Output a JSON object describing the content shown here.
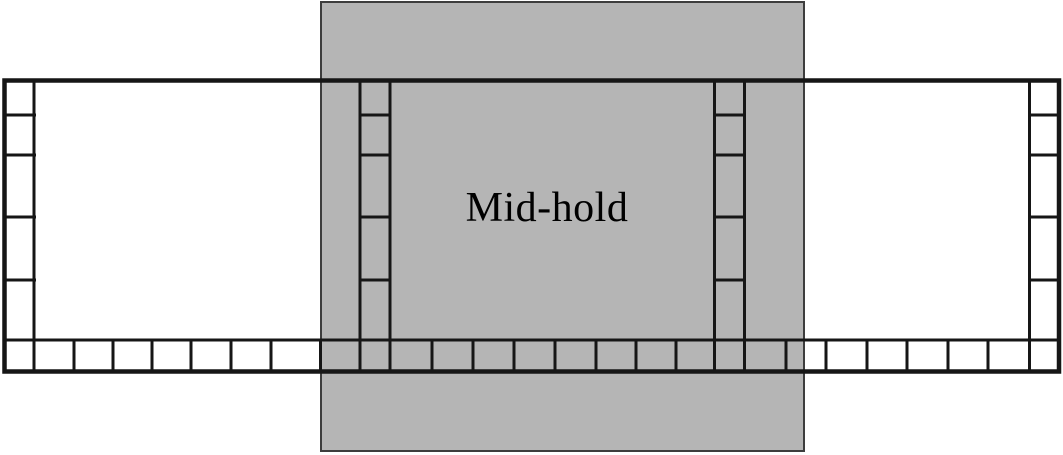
{
  "figure": {
    "label": "Mid-hold"
  },
  "colors": {
    "background": "#ffffff",
    "overlay_fill": "#b5b5b5",
    "overlay_border": "#3d3d3d",
    "line": "#161616",
    "text": "#000000"
  }
}
